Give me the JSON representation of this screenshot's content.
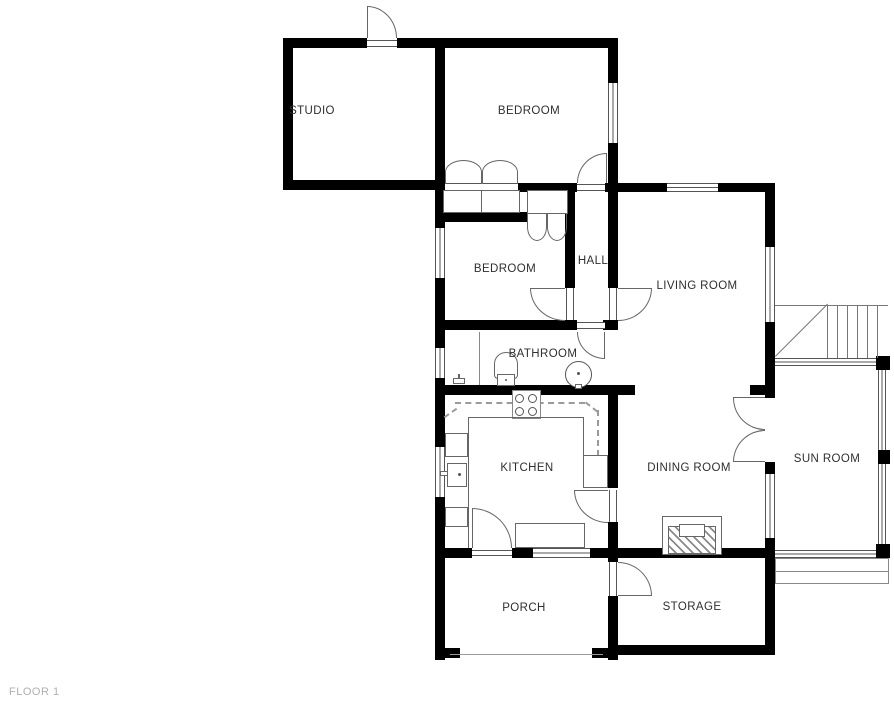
{
  "plan": {
    "floor_label": "FLOOR 1",
    "rooms": {
      "studio": "STUDIO",
      "bedroom_top": "BEDROOM",
      "bedroom_mid": "BEDROOM",
      "hall": "HALL",
      "living_room": "LIVING ROOM",
      "bathroom": "BATHROOM",
      "kitchen": "KITCHEN",
      "dining_room": "DINING ROOM",
      "sun_room": "SUN ROOM",
      "porch": "PORCH",
      "storage": "STORAGE"
    },
    "colors": {
      "wall": "#000000",
      "line": "#666666",
      "label": "#2f2f2f",
      "floor_label": "#b0b0b0"
    },
    "fixtures": [
      "exterior-door",
      "wardrobe-double-doors",
      "closet-bifold-doors",
      "toilet",
      "bathroom-sink",
      "shower-partition",
      "stove",
      "kitchen-sink",
      "kitchen-counter",
      "kitchen-appliance",
      "fireplace",
      "stairs",
      "sunroom-steps",
      "french-double-doors"
    ]
  }
}
